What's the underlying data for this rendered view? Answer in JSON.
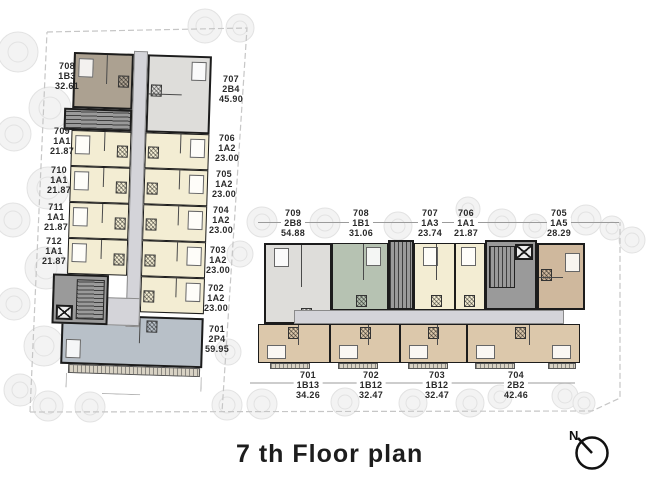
{
  "title": "7 th Floor plan",
  "compass_label": "N",
  "left_tower": {
    "west_units": [
      {
        "no": "708",
        "type": "1B3",
        "area": "32.61"
      },
      {
        "no": "709",
        "type": "1A1",
        "area": "21.87"
      },
      {
        "no": "710",
        "type": "1A1",
        "area": "21.87"
      },
      {
        "no": "711",
        "type": "1A1",
        "area": "21.87"
      },
      {
        "no": "712",
        "type": "1A1",
        "area": "21.87"
      }
    ],
    "east_units": [
      {
        "no": "707",
        "type": "2B4",
        "area": "45.90"
      },
      {
        "no": "706",
        "type": "1A2",
        "area": "23.00"
      },
      {
        "no": "705",
        "type": "1A2",
        "area": "23.00"
      },
      {
        "no": "704",
        "type": "1A2",
        "area": "23.00"
      },
      {
        "no": "703",
        "type": "1A2",
        "area": "23.00"
      },
      {
        "no": "702",
        "type": "1A2",
        "area": "23.00"
      },
      {
        "no": "701",
        "type": "2P4",
        "area": "59.95"
      }
    ]
  },
  "right_wing": {
    "north_units": [
      {
        "no": "709",
        "type": "2B8",
        "area": "54.88"
      },
      {
        "no": "708",
        "type": "1B1",
        "area": "31.06"
      },
      {
        "no": "707",
        "type": "1A3",
        "area": "23.74"
      },
      {
        "no": "706",
        "type": "1A1",
        "area": "21.87"
      },
      {
        "no": "705",
        "type": "1A5",
        "area": "28.29"
      }
    ],
    "south_units": [
      {
        "no": "701",
        "type": "1B13",
        "area": "34.26"
      },
      {
        "no": "702",
        "type": "1B12",
        "area": "32.47"
      },
      {
        "no": "703",
        "type": "1B12",
        "area": "32.47"
      },
      {
        "no": "704",
        "type": "2B2",
        "area": "42.46"
      }
    ]
  },
  "colors": {
    "wall": "#1c1c1c",
    "corridor": "#d4d4d9",
    "cream": "#f3edd3",
    "taupe": "#aca191",
    "gray_unit": "#dedddA",
    "sage": "#b6c2b2",
    "tan": "#dcc8ab",
    "brown": "#cfb89d",
    "bluegray": "#b8c0c8",
    "core": "#9a9a9a",
    "boundary": "#c6c6c6",
    "tree_fill": "#f1f1f1",
    "tree_ring": "#dedede",
    "text": "#2a2a2a"
  }
}
